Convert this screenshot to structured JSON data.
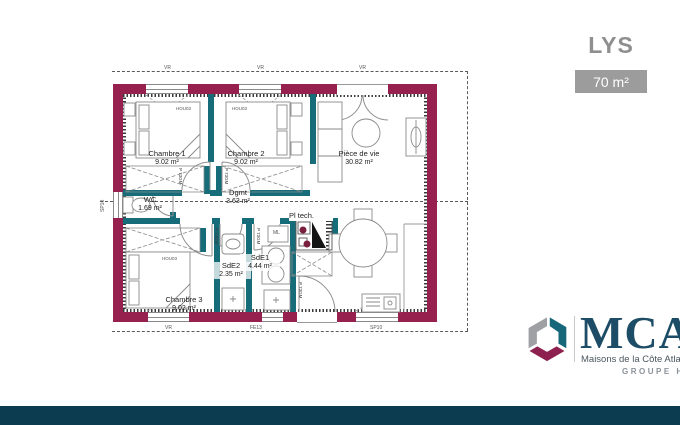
{
  "header": {
    "model_name": "LYS",
    "surface_label": "70 m²"
  },
  "plan": {
    "rooms": [
      {
        "label": "Chambre 1",
        "area": "9.02 m²"
      },
      {
        "label": "Chambre 2",
        "area": "9.02 m²"
      },
      {
        "label": "Pièce de vie",
        "area": "30.82 m²"
      },
      {
        "label": "Dgmt",
        "area": "3.63 m²"
      },
      {
        "label": "WC",
        "area": "1.69 m²"
      },
      {
        "label": "SdE2",
        "area": "2.35 m²"
      },
      {
        "label": "SdE1",
        "area": "4.44 m²"
      },
      {
        "label": "Chambre 3",
        "area": "9.02 m²"
      },
      {
        "label": "Pl tech.",
        "area": ""
      }
    ],
    "fixtures": {
      "washing_machine": "ML",
      "bed_ref": "HOU03"
    },
    "dimension_marks": {
      "top": [
        "VR",
        "VR",
        "VR"
      ],
      "bottom": [
        "VR",
        "FE13",
        "SP10"
      ],
      "left": "SP10",
      "door_jamb": "P 73GM"
    },
    "colors": {
      "exterior_wall": "#96214F",
      "partition": "#176C7A"
    }
  },
  "logo": {
    "acronym": "MCA",
    "subtitle": "Maisons de la Côte Atlantique",
    "group_label": "GROUPE HEXAOM",
    "colors": {
      "text": "#1D4D66",
      "cube_gray": "#9EA0A3",
      "cube_teal": "#17677A",
      "cube_maroon": "#8E2050"
    }
  },
  "footer": {
    "bar_color": "#0C3C50"
  }
}
